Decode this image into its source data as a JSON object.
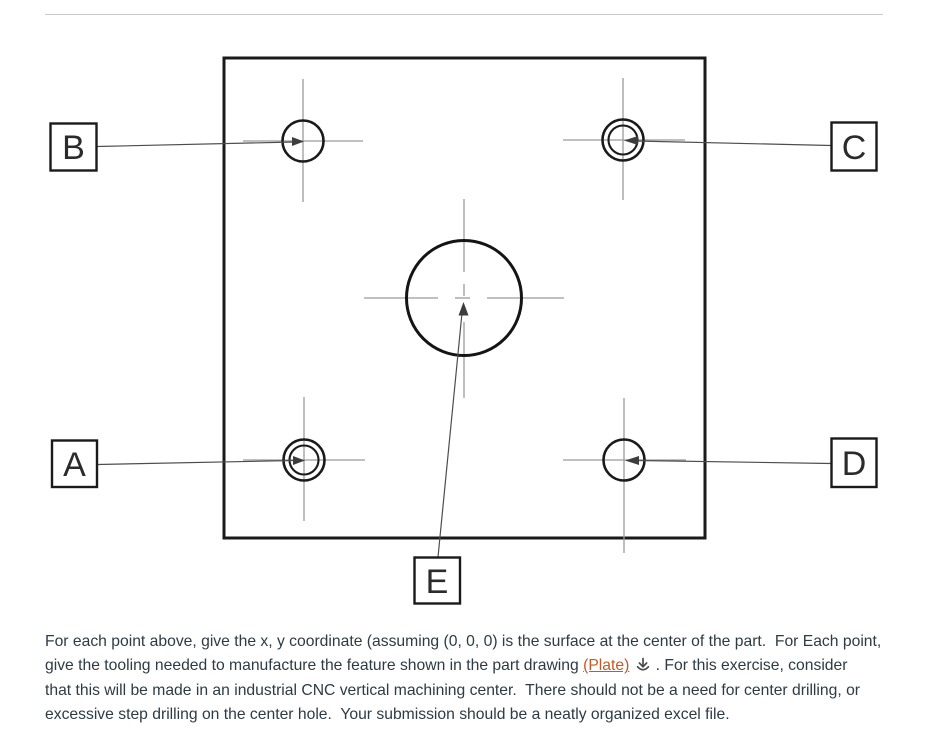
{
  "drawing": {
    "labels": {
      "a": "A",
      "b": "B",
      "c": "C",
      "d": "D",
      "e": "E"
    },
    "line_color": "#1a1a1a",
    "crosshair_color": "#9b9b9b",
    "leader_color": "#4d4d4d"
  },
  "paragraph": {
    "line1": "For each point above, give the x, y coordinate (assuming (0, 0, 0) is the surface at the center of the part.  For Each point,",
    "line2_pre": "give the tooling needed to manufacture the feature shown in the part drawing ",
    "link_text": "(Plate)",
    "line2_post": " . For this exercise, consider",
    "line3": "that this will be made in an industrial CNC vertical machining center.  There should not be a need for center drilling, or",
    "line4": "excessive step drilling on the center hole.  Your submission should be a neatly organized excel file.",
    "link_color": "#c25a26",
    "text_color": "#2d3b45",
    "download_icon": "download-icon"
  }
}
